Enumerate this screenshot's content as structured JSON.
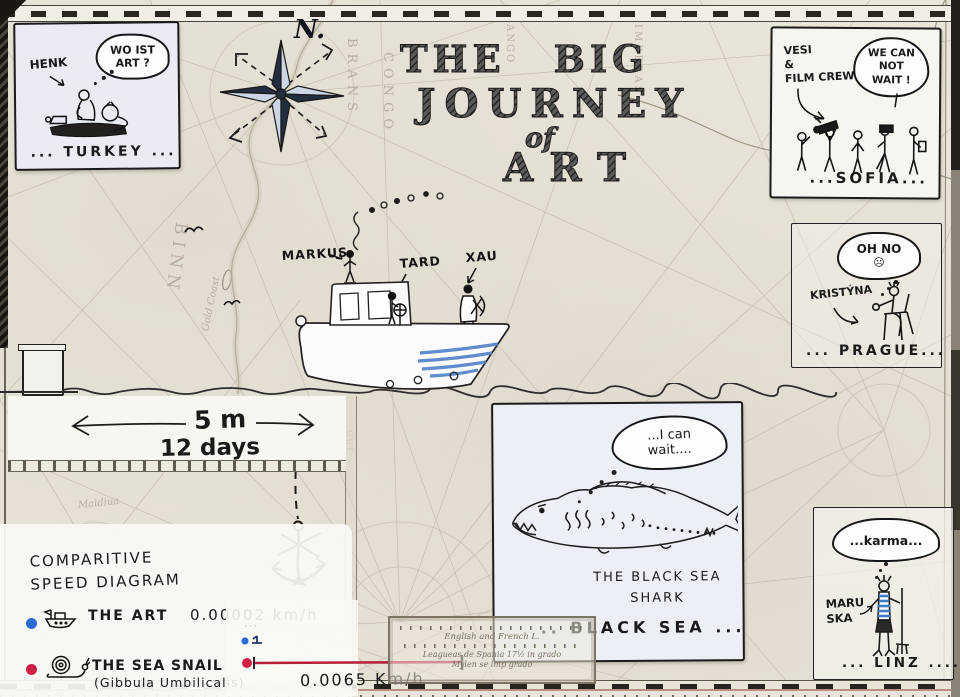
{
  "colors": {
    "parchment": "#e9e5db",
    "panel_paper": "#edeff7",
    "ink": "#1a1a1a",
    "boat_stripe": "#4f81c7",
    "art_speed_color": "#2a6bd4",
    "snail_speed_color": "#cf1f44"
  },
  "title": {
    "line1": "THE BIG",
    "line2": "JOURNEY",
    "line3": "of",
    "line4": "ART"
  },
  "compass": {
    "label": "N."
  },
  "panels": {
    "turkey": {
      "character": "HENK",
      "bubble": "WO IST\nART ?",
      "caption": "... TURKEY ..."
    },
    "sofia": {
      "character": "VESI\n&\nFILM CREW",
      "bubble": "WE CAN\nNOT\nWAIT !",
      "caption": "...SOFIA..."
    },
    "prague": {
      "character": "KRISTÝNA",
      "bubble": "OH NO",
      "bubble_face": "☹",
      "caption": "... PRAGUE..."
    },
    "linz": {
      "character": "MARU\nSKA",
      "bubble": "...karma...",
      "caption": "... LINZ ...."
    },
    "black_sea": {
      "bubble": "...I can\nwait....",
      "label": "THE  BLACK  SEA\nSHARK",
      "caption": ".. BLACK SEA ..."
    }
  },
  "boat": {
    "crew": {
      "captain": "MARKUS",
      "deckhand": "TARD",
      "stern": "XAU"
    }
  },
  "measurement": {
    "distance": "5 m",
    "duration": "12 days"
  },
  "speed_diagram": {
    "title": "COMPARITIVE\nSPEED DIAGRAM",
    "art_label": "THE ART",
    "art_speed": "0.00002 km/h",
    "snail_label": "THE SEA SNAIL",
    "snail_latin": "(Gibbula Umbilicalis)",
    "snail_speed": "0.0065 Km/h"
  },
  "map_background": {
    "fragments": {
      "binn": "BINN",
      "gold_coast": "Gold Coast",
      "congo": "CONGO",
      "brans": "BRANS",
      "imberas": "IMBERAS",
      "ango": "ANGO",
      "maldiua": "Maldiua",
      "gui": "GUI"
    },
    "scale_box": {
      "line1": "English and French L.",
      "line2": "Leagueas de Spania 17½ in grado",
      "line3": "Mylen se imp grado"
    }
  }
}
